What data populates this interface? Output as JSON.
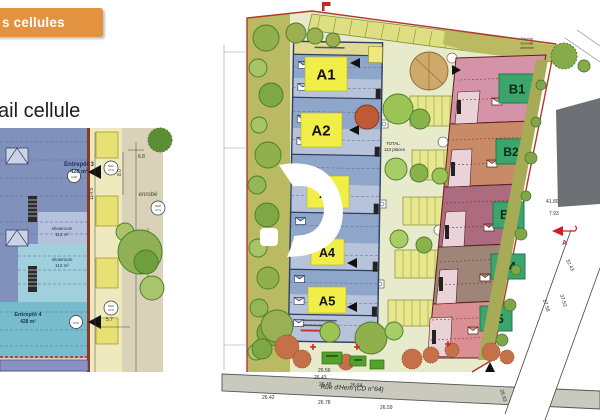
{
  "header": {
    "banner_label": "s cellules",
    "section_title": "ail cellule"
  },
  "detail_plan": {
    "entrepot3_name": "Entrepôt 3",
    "entrepot3_area": "428 m²",
    "showroom1_name": "showroom",
    "showroom1_area": "112 m²",
    "showroom2_name": "showroom",
    "showroom2_area": "112 m²",
    "entrepot4_name": "Entrepôt 4",
    "entrepot4_area": "428 m²",
    "surface_label": "enrobé",
    "ngf_label": "NGF",
    "ngf_value": "27.0",
    "dimensions": {
      "top": "6.8",
      "upper_side": "8.0",
      "side": "114.5",
      "mid1": "7.1",
      "mid2": "6.7",
      "lower": "5.7"
    }
  },
  "site_plan": {
    "cells_a": [
      {
        "id": "A1"
      },
      {
        "id": "A2"
      },
      {
        "id": "A3"
      },
      {
        "id": "A4"
      },
      {
        "id": "A5"
      }
    ],
    "cells_b": [
      {
        "id": "B1"
      },
      {
        "id": "B2"
      },
      {
        "id": "B3"
      },
      {
        "id": "B4"
      },
      {
        "id": "B5"
      }
    ],
    "parking_total_line1": "TOTAL",
    "parking_total_line2": "113 places",
    "reserve_note_lines": [
      "Réserve",
      "incendie",
      "aérienne"
    ],
    "street_name": "Rue d'Hem (CD n°64)",
    "dims_above_street": [
      "26.56",
      "26.43",
      "26.48",
      "26.64"
    ],
    "dims_below_street": [
      "26.42",
      "26.78",
      "26.59"
    ],
    "dims_right_margin": [
      "41.80",
      "7.93",
      "32.43"
    ],
    "dims_road": [
      "27.58",
      "37.53",
      "26.93"
    ],
    "section_marker_label": "A",
    "colors": {
      "banner": "#e3923f",
      "cell_a_label_bg": "#f2ee48",
      "cell_b_label_bg": "#3ca56c",
      "building_a": "#8ea6c9",
      "building_a_light": "#b7c3da",
      "building_b1": "#d593a9",
      "building_b2": "#c98a68",
      "building_b3": "#ad6b80",
      "building_b4": "#9f8478",
      "building_b5": "#da8f92",
      "entrepot3": "#8092bc",
      "showroom1": "#b6c1de",
      "showroom2": "#9fd0db",
      "entrepot4": "#77bccd",
      "street": "#c9c9bd"
    }
  }
}
